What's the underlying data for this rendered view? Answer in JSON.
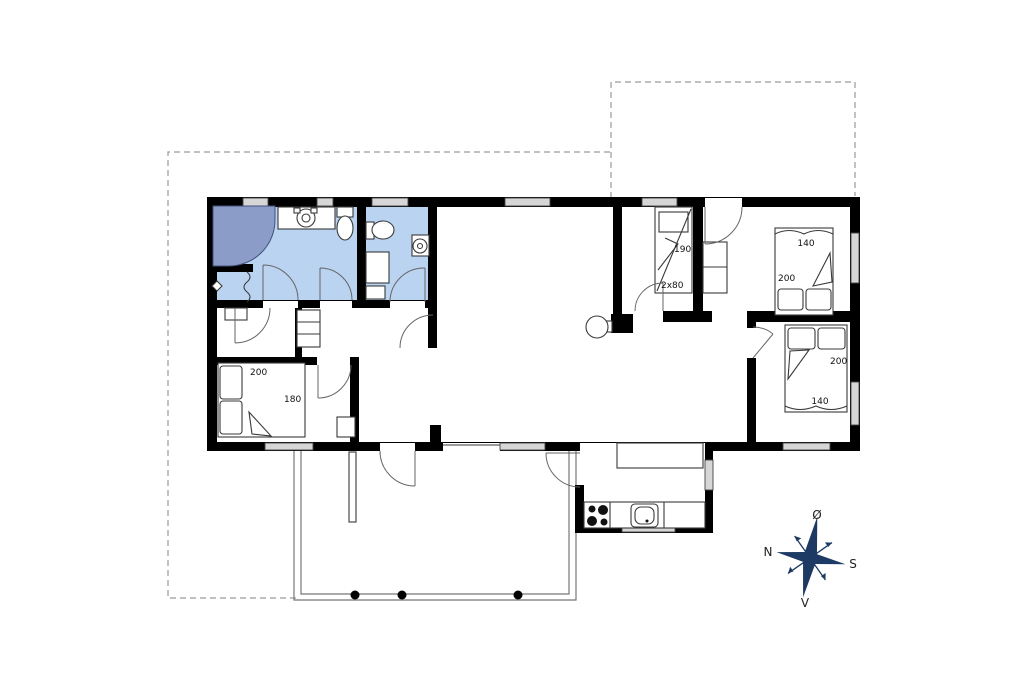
{
  "floorplan": {
    "dimension_labels": {
      "bedroom_top_right": {
        "width": "140",
        "length": "200"
      },
      "bunk_room": {
        "length": "190",
        "size": "2x80"
      },
      "bedroom_bottom_right": {
        "length": "200",
        "width": "140"
      },
      "bedroom_left": {
        "length": "200",
        "width": "180"
      }
    },
    "compass": {
      "east": "Ø",
      "north": "N",
      "south": "S",
      "west": "V"
    },
    "colors": {
      "wall": "#000000",
      "bath_floor": "#b9d3f1",
      "shower": "#8b9cc8",
      "window": "#d6d6d6",
      "furniture_line": "#3a3a3a",
      "door_arc": "#666666",
      "terrace_line": "#777777",
      "plot_boundary": "#9a9a9a",
      "compass": "#1d3a64",
      "label_text": "#111111"
    }
  }
}
